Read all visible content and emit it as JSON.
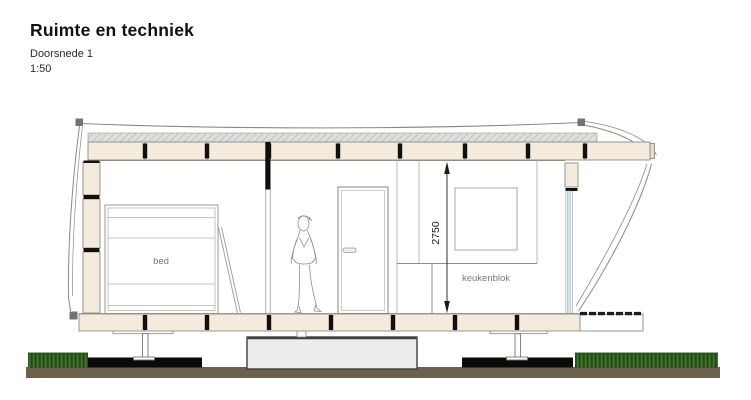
{
  "header": {
    "title": "Ruimte en techniek",
    "subtitle": "Doorsnede 1",
    "scale": "1:50"
  },
  "drawing": {
    "labels": {
      "bed": "bed",
      "kitchen": "keukenblok",
      "ceiling_height": "2750"
    },
    "colors": {
      "panel": "#f4ebdd",
      "panel_border": "#8d8c83",
      "separator": "#101010",
      "glass": "#cde3f0",
      "concrete": "#ececec",
      "concrete_border": "#3f3f3f",
      "pavement": "#0a0a0a",
      "ground": "#6c604f",
      "grass": "#3a6b28",
      "outline": "#8a8a85"
    }
  }
}
